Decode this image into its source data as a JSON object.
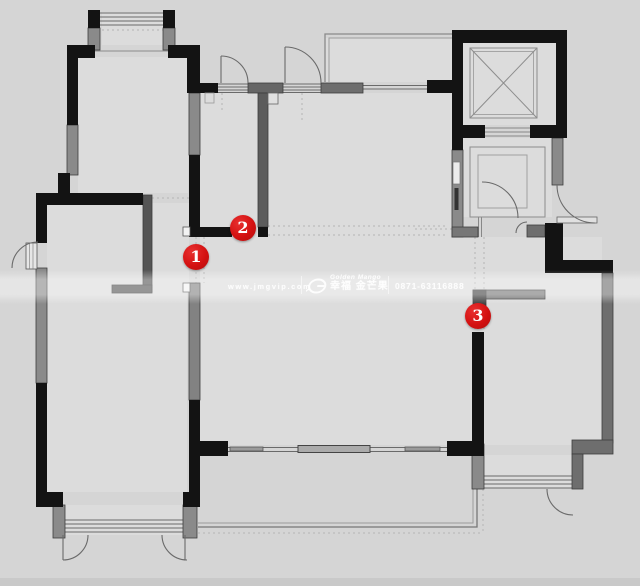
{
  "watermark": {
    "website": "www.jmgvip.com",
    "brand_en": "Golden Mango",
    "brand_cn": "幸福 金芒果",
    "phone": "0871-63116888"
  },
  "markers": [
    {
      "label": "1"
    },
    {
      "label": "2"
    },
    {
      "label": "3"
    }
  ],
  "colors": {
    "background": "#d5d5d5",
    "room_fill": "#dcdcdc",
    "wall_black": "#131313",
    "wall_dark_gray": "#5c5c5c",
    "wall_gray": "#8a8a8a",
    "thin_line": "#6a6a6a",
    "guide_dotted": "#b5b5b5",
    "marker_red": "#d41111",
    "watermark_text": "#ffffff"
  },
  "icons": [
    {
      "name": "golden-mango-logo-icon"
    },
    {
      "name": "elevator-cross-icon"
    }
  ]
}
